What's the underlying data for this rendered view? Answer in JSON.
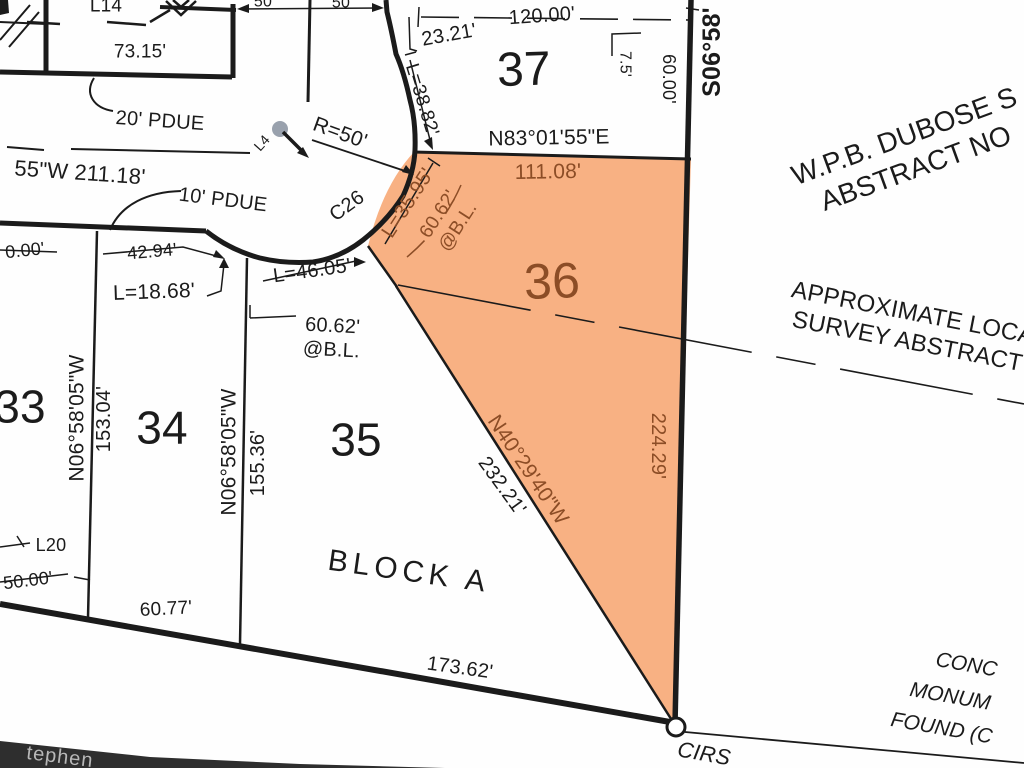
{
  "title": "Subdivision plat survey detail - Block A lots 33-37, lot 36 highlighted",
  "colors": {
    "lot36_fill": "#F8B183",
    "plat_text_brown": "#8C4D26",
    "line_black": "#1b1b1b",
    "watermark_band": "#2e2e2e",
    "watermark_text": "#b8b8b8",
    "center_dot": "#99a1ad"
  },
  "labels": {
    "l14": "L14",
    "d7315": "73.15'",
    "pdue20": "20' PDUE",
    "bearing211": "55\"W  211.18'",
    "pdue10": "10' PDUE",
    "d4294": "42.94'",
    "l1868": "L=18.68'",
    "l4605": "L=46.05'",
    "lot35_bl": "60.62'\n@B.L.",
    "lot33": "33",
    "lot34": "34",
    "lot35": "35",
    "lot36": "36",
    "lot37": "37",
    "bearing33": "N06°58'05\"W",
    "dist33": "153.04'",
    "bearing34": "N06°58'05\"W",
    "dist34": "155.36'",
    "bearing_right": "S06°58'",
    "d6000": "60.00'",
    "d75": "7.5'",
    "d22429": "224.29'",
    "n8301": "N83°01'55\"E",
    "d11108": "111.08'",
    "l3595": "L=35.95'",
    "lot36_bl": "60.62'\n@B.L.",
    "l3882": "L=38.82'",
    "d2321": "23.21'",
    "d12000": "120.00'",
    "c26": "C26",
    "r50": "R=50'",
    "l4": "L4",
    "n4029": "N40°29'40\"W",
    "d23221": "232.21'",
    "dubose": "W.P.B. DUBOSE S\nABSTRACT NO",
    "approx": "APPROXIMATE LOCA\nSURVEY ABSTRACT",
    "blocka": "BLOCK A",
    "d17362": "173.62'",
    "cirs": "CIRS",
    "conc1": "CONC",
    "conc2": "MONUM",
    "conc3": "FOUND (C",
    "t50a": "50",
    "t50b": "50",
    "d000": "0.00'",
    "d5000": "50.00'",
    "l20": "L20",
    "d6077": "60.77'",
    "tephen": "tephen"
  }
}
